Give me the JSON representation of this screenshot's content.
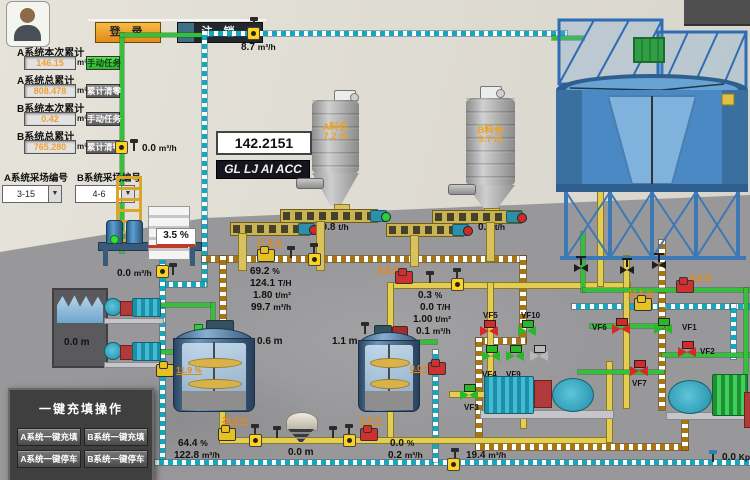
{
  "header": {
    "login": "登 录",
    "logout": "注 销"
  },
  "panel": {
    "rows": [
      {
        "label": "A系统本次累计",
        "value": "146.15",
        "unit": "m³",
        "button": "手动任务"
      },
      {
        "label": "A系统总累计",
        "value": "808.478",
        "unit": "m³",
        "button": "累计清零"
      },
      {
        "label": "B系统本次累计",
        "value": "0.42",
        "unit": "m³",
        "button": "手动任务"
      },
      {
        "label": "B系统总累计",
        "value": "765.280",
        "unit": "m³",
        "button": "累计清零"
      }
    ],
    "selectors": [
      {
        "label": "A系统采场编号",
        "value": "3-15"
      },
      {
        "label": "B系统采场编号",
        "value": "4-6"
      }
    ]
  },
  "displays": {
    "totalizer": "142.2151",
    "marquee": "GL LJ AI ACC"
  },
  "silos": {
    "a_name": "A料仓",
    "a_level": "7.2 m",
    "a_rate": "10.8",
    "a_rate_u": "t/h",
    "b_name": "B料仓",
    "b_level": "9.7 m",
    "b_rate": "0.0",
    "b_rate_u": "t/h"
  },
  "flows": {
    "top": "8.7",
    "top_u": "m³/h",
    "left": "0.0",
    "left_u": "m³/h",
    "platform": "0.0",
    "platform_u": "m³/h",
    "bottom": "19.4",
    "bottom_u": "m³/h",
    "pressure": "0.0",
    "pressure_u": "Kpa",
    "out_a_pct": "64.4",
    "out_a_pct_u": "%",
    "out_a_flow": "122.8",
    "out_a_flow_u": "m³/h",
    "out_b_pct": "0.0",
    "out_b_pct_u": "%",
    "out_b_flow": "0.2",
    "out_b_flow_u": "m³/h"
  },
  "levels": {
    "pool": "0.0 m",
    "agitator1": "0.6 m",
    "agitator2": "1.1 m",
    "hopper": "0.0 m",
    "tank_conc": "3.5 %"
  },
  "stations": {
    "a": {
      "rows": [
        {
          "v": "69.2",
          "u": "%"
        },
        {
          "v": "124.1",
          "u": "T/H"
        },
        {
          "v": "1.80",
          "u": "t/m³"
        },
        {
          "v": "99.7",
          "u": "m³/h"
        }
      ]
    },
    "b": {
      "rows": [
        {
          "v": "0.3",
          "u": "%"
        },
        {
          "v": "0.0",
          "u": "T/H"
        },
        {
          "v": "1.00",
          "u": "t/m³"
        },
        {
          "v": "0.1",
          "u": "m³/h"
        }
      ]
    }
  },
  "pumps": {
    "feed_a": "17.9 %",
    "pool_line": "11.9 %",
    "station_b_inlet": "0.0 %",
    "agitator2_out": "0.0 %",
    "bottom_left": "26.8 %",
    "bottom_right": "0.0 %",
    "right_top": "0.0 %",
    "right_mid": "11.5 %"
  },
  "valves": [
    {
      "id": "VF1",
      "color": "green"
    },
    {
      "id": "VF2",
      "color": "red"
    },
    {
      "id": "VF3",
      "color": "green"
    },
    {
      "id": "VF4",
      "color": "green"
    },
    {
      "id": "VF5",
      "color": "red"
    },
    {
      "id": "VF6",
      "color": "red"
    },
    {
      "id": "VF7",
      "color": "red"
    },
    {
      "id": "VF8",
      "color": "red"
    },
    {
      "id": "VF9",
      "color": "green"
    },
    {
      "id": "VF10",
      "color": "green"
    }
  ],
  "ops": {
    "title": "一键充填操作",
    "buttons": [
      "A系统一键充填",
      "B系统一键充填",
      "A系统一键停车",
      "B系统一键停车"
    ]
  },
  "colors": {
    "pipe_fill": "#a87510",
    "pipe_water": "#17a7bd",
    "pipe_slurry": "#e3cd52",
    "pipe_clear": "#35bf3a",
    "valve_open": "#28b828",
    "valve_closed": "#d42a2a",
    "value_orange": "#f0a030"
  }
}
